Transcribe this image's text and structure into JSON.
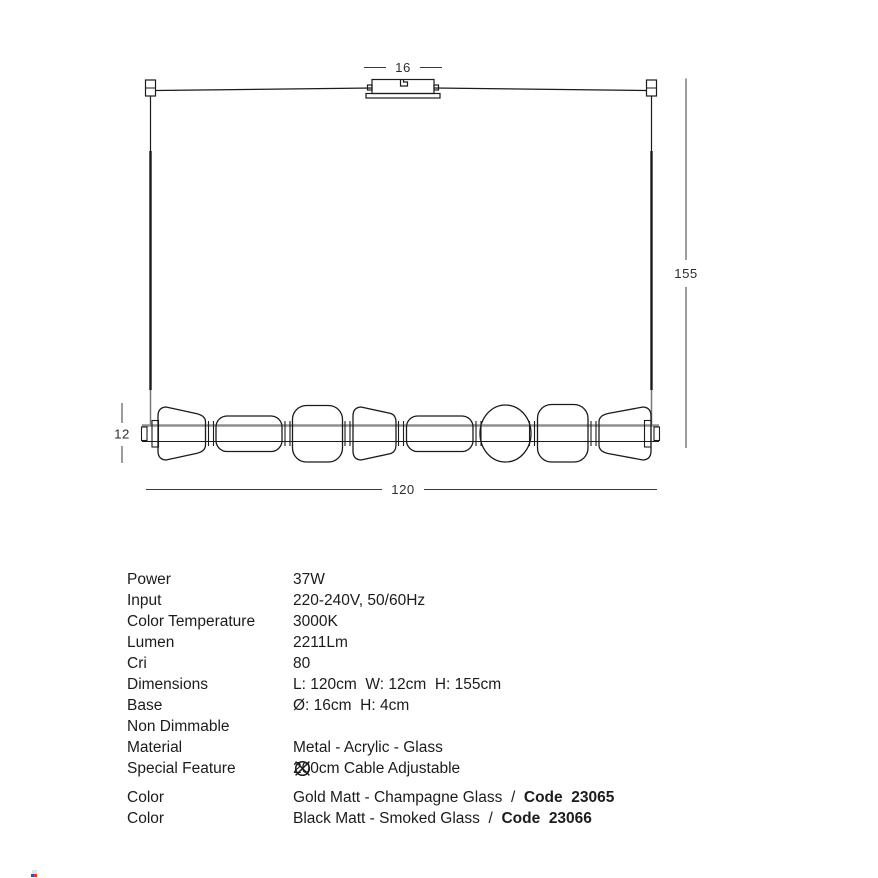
{
  "drawing": {
    "dims": {
      "canopy_width": "16",
      "total_height": "155",
      "glass_height": "12",
      "length": "120"
    }
  },
  "specs": {
    "rows": [
      {
        "label": "Power",
        "value": "37W"
      },
      {
        "label": "Input",
        "value": "220-240V, 50/60Hz"
      },
      {
        "label": "Color Temperature",
        "value": "3000K"
      },
      {
        "label": "Lumen",
        "value": "2211Lm"
      },
      {
        "label": "Cri",
        "value": "80"
      },
      {
        "label": "Dimensions",
        "value": "L: 120cm  W: 12cm  H: 155cm"
      },
      {
        "label": "Base",
        "value": "Ø: 16cm  H: 4cm"
      },
      {
        "label": "Non Dimmable",
        "value": "",
        "icon": "non-dimmable-icon"
      },
      {
        "label": "Material",
        "value": "Metal - Acrylic - Glass"
      },
      {
        "label": "Special Feature",
        "value": "200cm Cable Adjustable"
      }
    ]
  },
  "color_rows": [
    {
      "label": "Color",
      "value": "Gold Matt - Champagne Glass  /  ",
      "code": "Code  23065"
    },
    {
      "label": "Color",
      "value": "Black Matt - Smoked Glass  /  ",
      "code": "Code  23066"
    }
  ],
  "colors": {
    "line": "#1b1b1b",
    "bar_gray": "#8f8f8f",
    "dim_line": "#3a3a3a",
    "text": "#1c1c1c"
  }
}
